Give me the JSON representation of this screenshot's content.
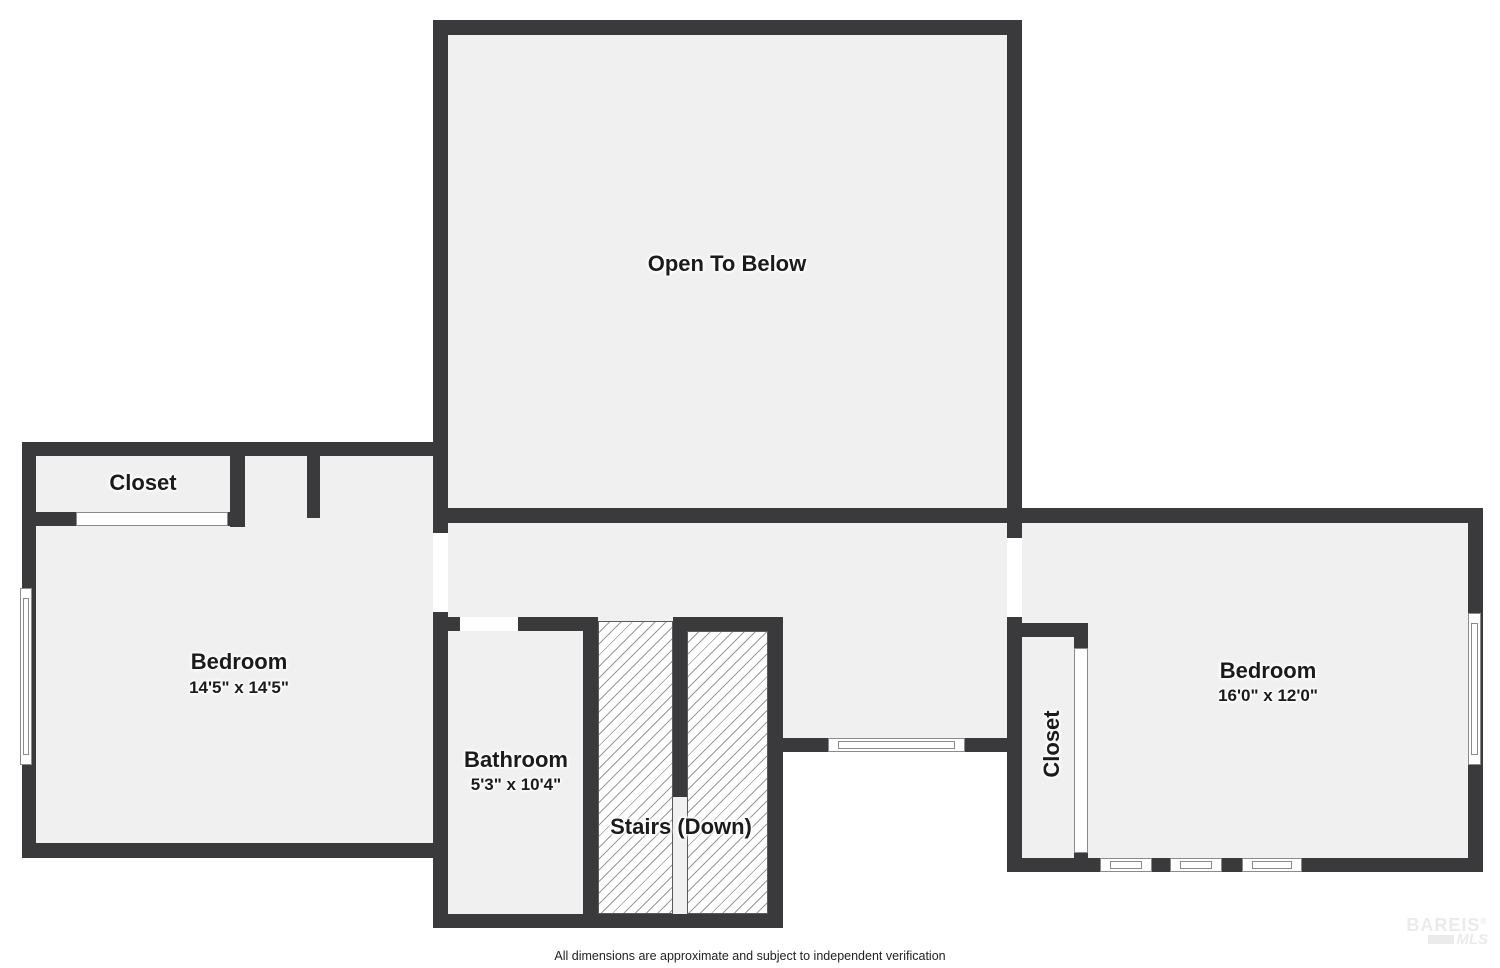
{
  "plan": {
    "rooms": {
      "open_to_below": {
        "label": "Open To Below"
      },
      "closet_left": {
        "label": "Closet"
      },
      "bedroom_left": {
        "label": "Bedroom",
        "dimensions": "14'5\" x 14'5\""
      },
      "bathroom": {
        "label": "Bathroom",
        "dimensions": "5'3\" x 10'4\""
      },
      "stairs": {
        "label": "Stairs (Down)"
      },
      "closet_right": {
        "label": "Closet"
      },
      "bedroom_right": {
        "label": "Bedroom",
        "dimensions": "16'0\" x 12'0\""
      }
    },
    "colors": {
      "wall": "#3a3a3c",
      "room_fill": "#f0f0f0",
      "hatch_line": "#9a9a9a",
      "page_background": "#ffffff"
    }
  },
  "footer": {
    "disclaimer": "All dimensions are approximate and subject to independent verification"
  },
  "watermark": {
    "name": "BAREIS",
    "reg": "®",
    "sub": "MLS"
  }
}
